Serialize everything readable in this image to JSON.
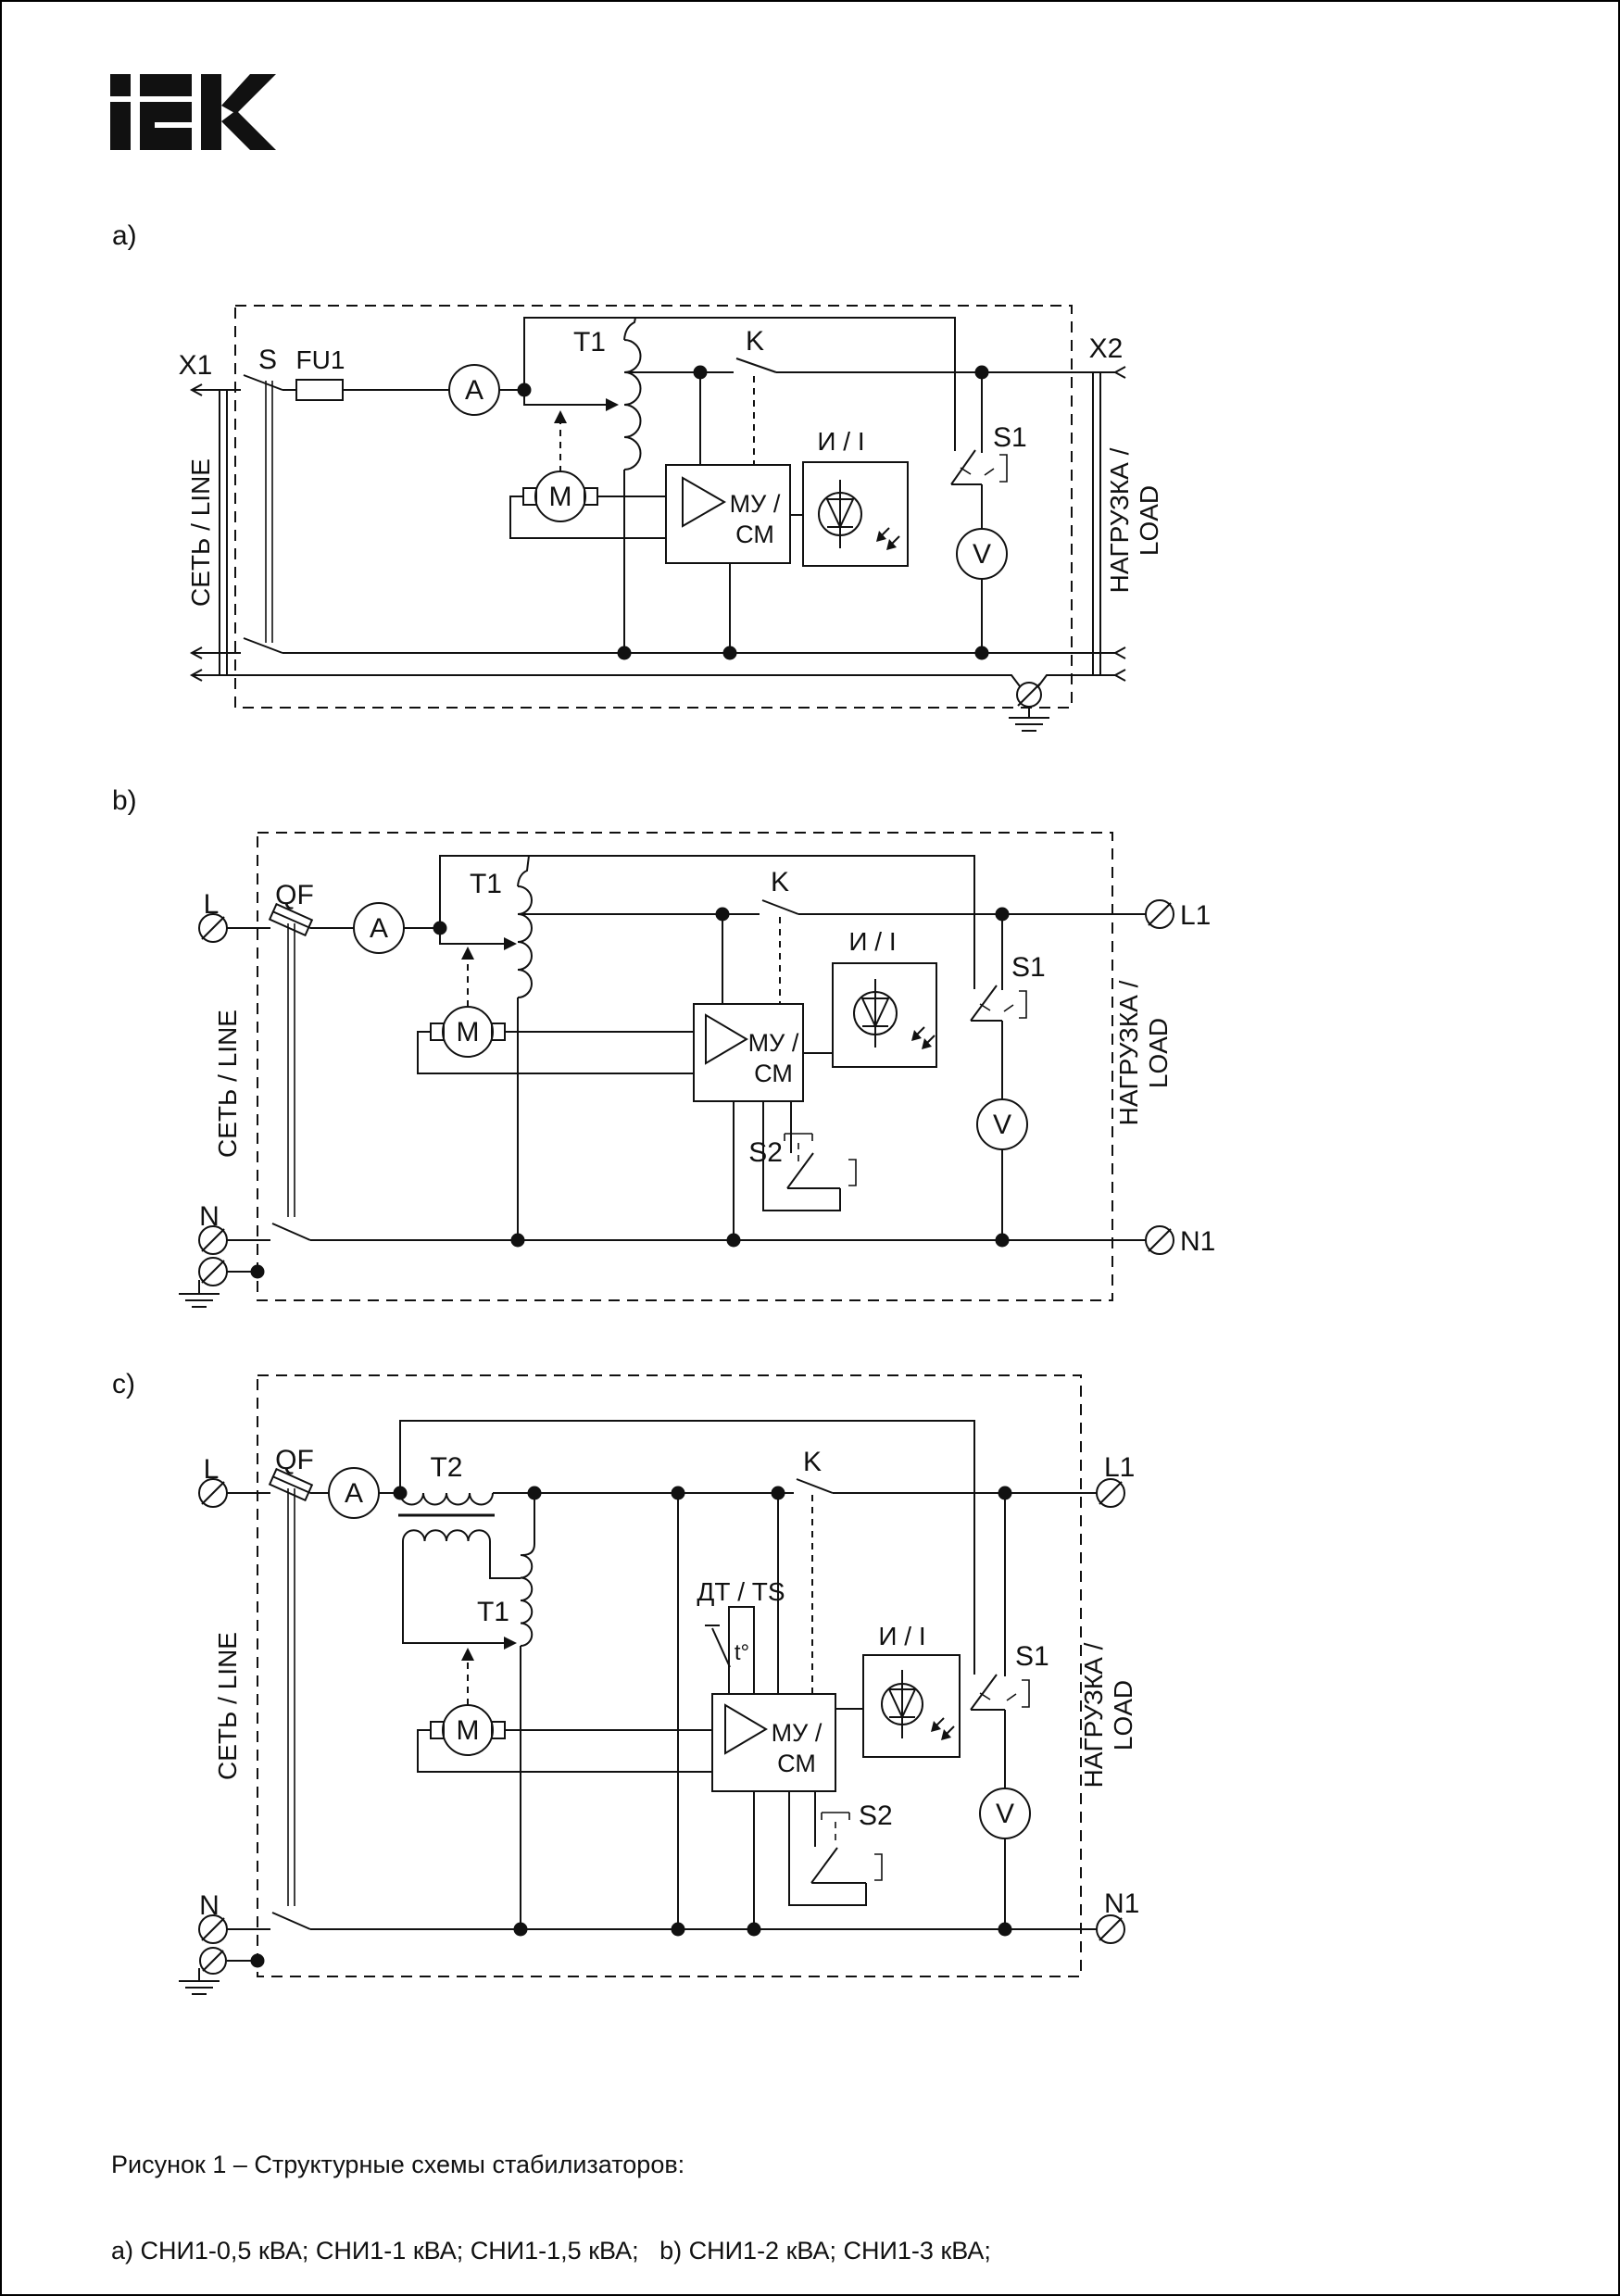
{
  "brand": {
    "logo": "IEK"
  },
  "diagrams": {
    "a": {
      "label": "a)",
      "x1": "X1",
      "s": "S",
      "fu1": "FU1",
      "ammeter": "A",
      "t1": "T1",
      "k": "K",
      "x2": "X2",
      "motor": "M",
      "mu_line1": "МУ /",
      "mu_line2": "СМ",
      "indicator": "И / I",
      "s1": "S1",
      "voltmeter": "V",
      "line_label": "СЕТЬ / LINE",
      "load_label1": "НАГРУЗКА /",
      "load_label2": "LOAD"
    },
    "b": {
      "label": "b)",
      "l": "L",
      "n": "N",
      "qf": "QF",
      "ammeter": "A",
      "t1": "T1",
      "k": "K",
      "l1": "L1",
      "n1": "N1",
      "motor": "M",
      "mu_line1": "МУ /",
      "mu_line2": "СМ",
      "indicator": "И / I",
      "s1": "S1",
      "s2": "S2",
      "voltmeter": "V",
      "line_label": "СЕТЬ / LINE",
      "load_label1": "НАГРУЗКА /",
      "load_label2": "LOAD"
    },
    "c": {
      "label": "c)",
      "l": "L",
      "n": "N",
      "qf": "QF",
      "ammeter": "A",
      "t2": "T2",
      "t1": "T1",
      "k": "K",
      "l1": "L1",
      "n1": "N1",
      "motor": "M",
      "mu_line1": "МУ /",
      "mu_line2": "СМ",
      "indicator": "И / I",
      "dt": "ДТ / TS",
      "t_sensor": "t°",
      "s1": "S1",
      "s2": "S2",
      "voltmeter": "V",
      "line_label": "СЕТЬ / LINE",
      "load_label1": "НАГРУЗКА /",
      "load_label2": "LOAD"
    }
  },
  "caption": {
    "line1": "Рисунок 1 – Структурные схемы стабилизаторов:",
    "line2": "a) СНИ1-0,5 кВА; СНИ1-1 кВА; СНИ1-1,5 кВА;   b) СНИ1-2 кВА; СНИ1-3 кВА;",
    "line3": "c) СНИ1-5 кВА; СНИ1-7 кВА; СНИ1-10 кВА; СНИ1-15 кВА; СНИ1-20 кВА; СНИ1-30 кВА"
  }
}
